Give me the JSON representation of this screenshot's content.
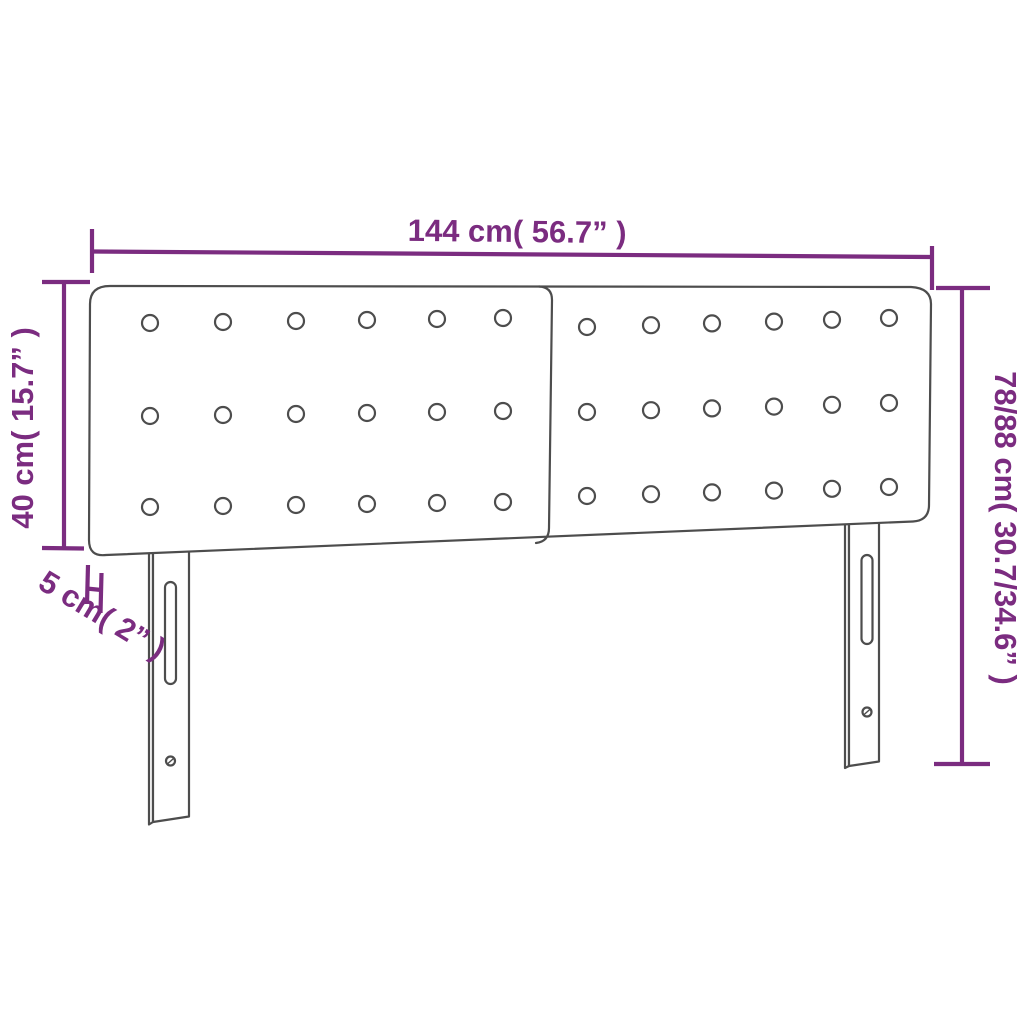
{
  "diagram": {
    "type": "product-dimension-diagram",
    "product": "upholstered headboard with two tufted panels and two slotted legs",
    "background_color": "#ffffff",
    "colors": {
      "dimension_color": "#7b2c80",
      "outline_color": "#4d4d4d"
    },
    "labels": {
      "width": "144 cm( 56.7” )",
      "panel_height": "40 cm( 15.7” )",
      "total_height": "78/88 cm( 30.7/34.6” )",
      "thickness": "5 cm( 2” )"
    },
    "tufting": {
      "panels": 2,
      "rows_per_panel": 3,
      "buttons_per_row": 6,
      "total_buttons": 36
    },
    "legs": {
      "count": 2,
      "features": [
        "adjustment slot",
        "screw hole"
      ]
    }
  }
}
